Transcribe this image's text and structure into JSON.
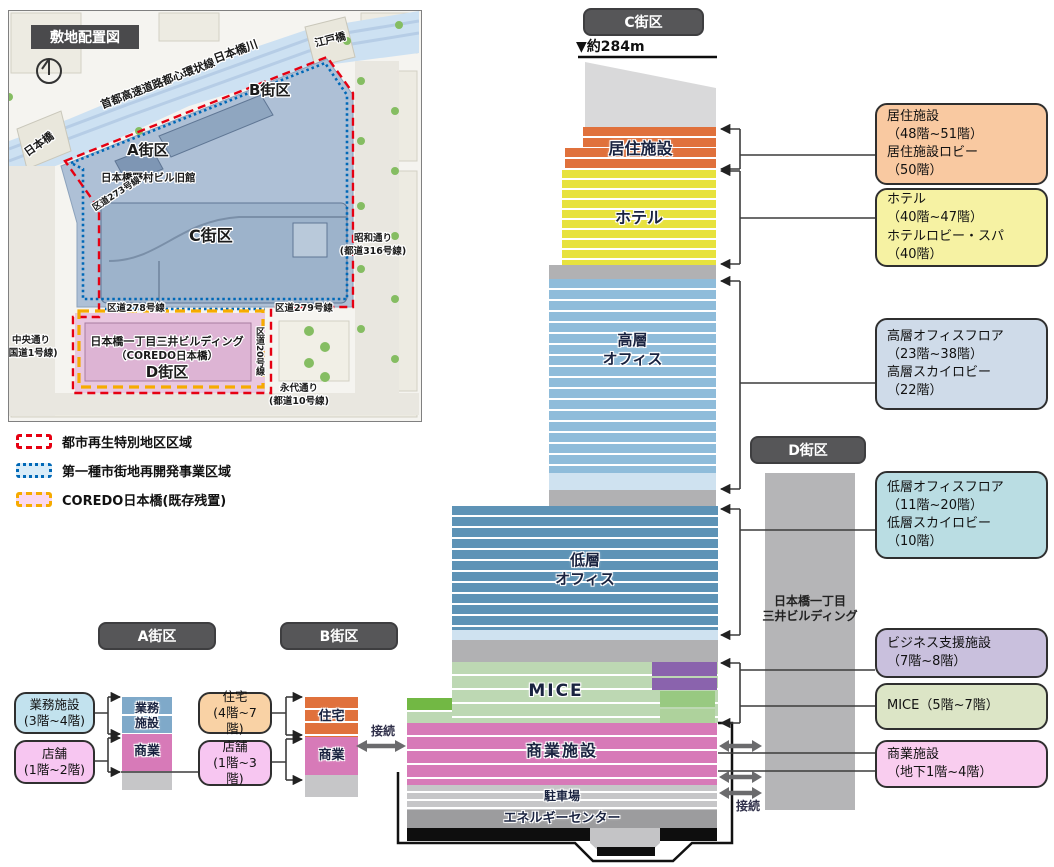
{
  "map": {
    "title": "敷地配置図",
    "labels": {
      "expressway": "首都高速道路都心環状線",
      "river": "日本橋川",
      "edobashi": "江戸橋",
      "nihonbashi_bridge": "日本橋",
      "block_a": "A街区",
      "block_b": "B街区",
      "block_c": "C街区",
      "block_d": "D街区",
      "nomura_bldg": "日本橋野村ビル旧館",
      "kudo273": "区道273号線",
      "kudo278": "区道278号線",
      "kudo279": "区道279号線",
      "kudo20": "区道20号線",
      "showa_dori": "昭和通り",
      "showa_dori_sub": "(都道316号線)",
      "chuo_dori": "中央通り",
      "chuo_dori_sub": "(国道1号線)",
      "eitai_dori": "永代通り",
      "eitai_dori_sub": "(都道10号線)",
      "mitsui_bldg": "日本橋一丁目三井ビルディング",
      "mitsui_bldg_sub": "（COREDO日本橋）"
    }
  },
  "legend": {
    "items": [
      {
        "label": "都市再生特別地区区域",
        "color": "#e60012"
      },
      {
        "label": "第一種市街地再開発事業区域",
        "color": "#0068b7"
      },
      {
        "label": "COREDO日本橋(既存残置)",
        "color": "#f6ab00"
      }
    ]
  },
  "tower_c": {
    "header": "C街区",
    "height": "▼約284m",
    "residential": "居住施設",
    "hotel": "ホテル",
    "high_office": "高層\nオフィス",
    "low_office": "低層\nオフィス",
    "mice": "MICE",
    "commercial": "商業施設",
    "parking": "駐車場",
    "energy_center": "エネルギーセンター"
  },
  "tower_d": {
    "header": "D街区",
    "name": "日本橋一丁目\n三井ビルディング"
  },
  "block_a": {
    "header": "A街区",
    "callout_office": "業務施設\n(3階~4階)",
    "callout_shop": "店舗\n(1階~2階)",
    "label_office": "業務\n施設",
    "label_commercial": "商業"
  },
  "block_b": {
    "header": "B街区",
    "callout_house": "住宅\n(4階~7階)",
    "callout_shop": "店舗\n(1階~3階)",
    "label_house": "住宅",
    "label_commercial": "商業"
  },
  "callouts": [
    {
      "text": "居住施設\n（48階~51階）\n居住施設ロビー\n（50階）",
      "color": "#f9c9a1"
    },
    {
      "text": "ホテル\n（40階~47階）\nホテルロビー・スパ\n（40階）",
      "color": "#f6f2a3"
    },
    {
      "text": "高層オフィスフロア\n（23階~38階）\n高層スカイロビー\n（22階）",
      "color": "#cfdbe9"
    },
    {
      "text": "低層オフィスフロア\n（11階~20階）\n低層スカイロビー\n（10階）",
      "color": "#badde3"
    },
    {
      "text": "ビジネス支援施設\n（7階~8階）",
      "color": "#c9c0dd"
    },
    {
      "text": "MICE（5階~7階）",
      "color": "#dce5c6"
    },
    {
      "text": "商業施設\n（地下1階~4階）",
      "color": "#f9cdef"
    }
  ],
  "connection": "接続",
  "colors": {
    "residential": "#e0713c",
    "hotel": "#e7e23e",
    "high_office": "#8fbcda",
    "low_office": "#5e93b6",
    "sky_lobby": "#cfe2f0",
    "mice": "#bdd8b3",
    "business_support": "#8a63ad",
    "commercial": "#d77ab8",
    "parking": "#c6c6c8",
    "energy": "#9c9c9e",
    "tower_d": "#b5b5b7",
    "badge": "#565658"
  }
}
